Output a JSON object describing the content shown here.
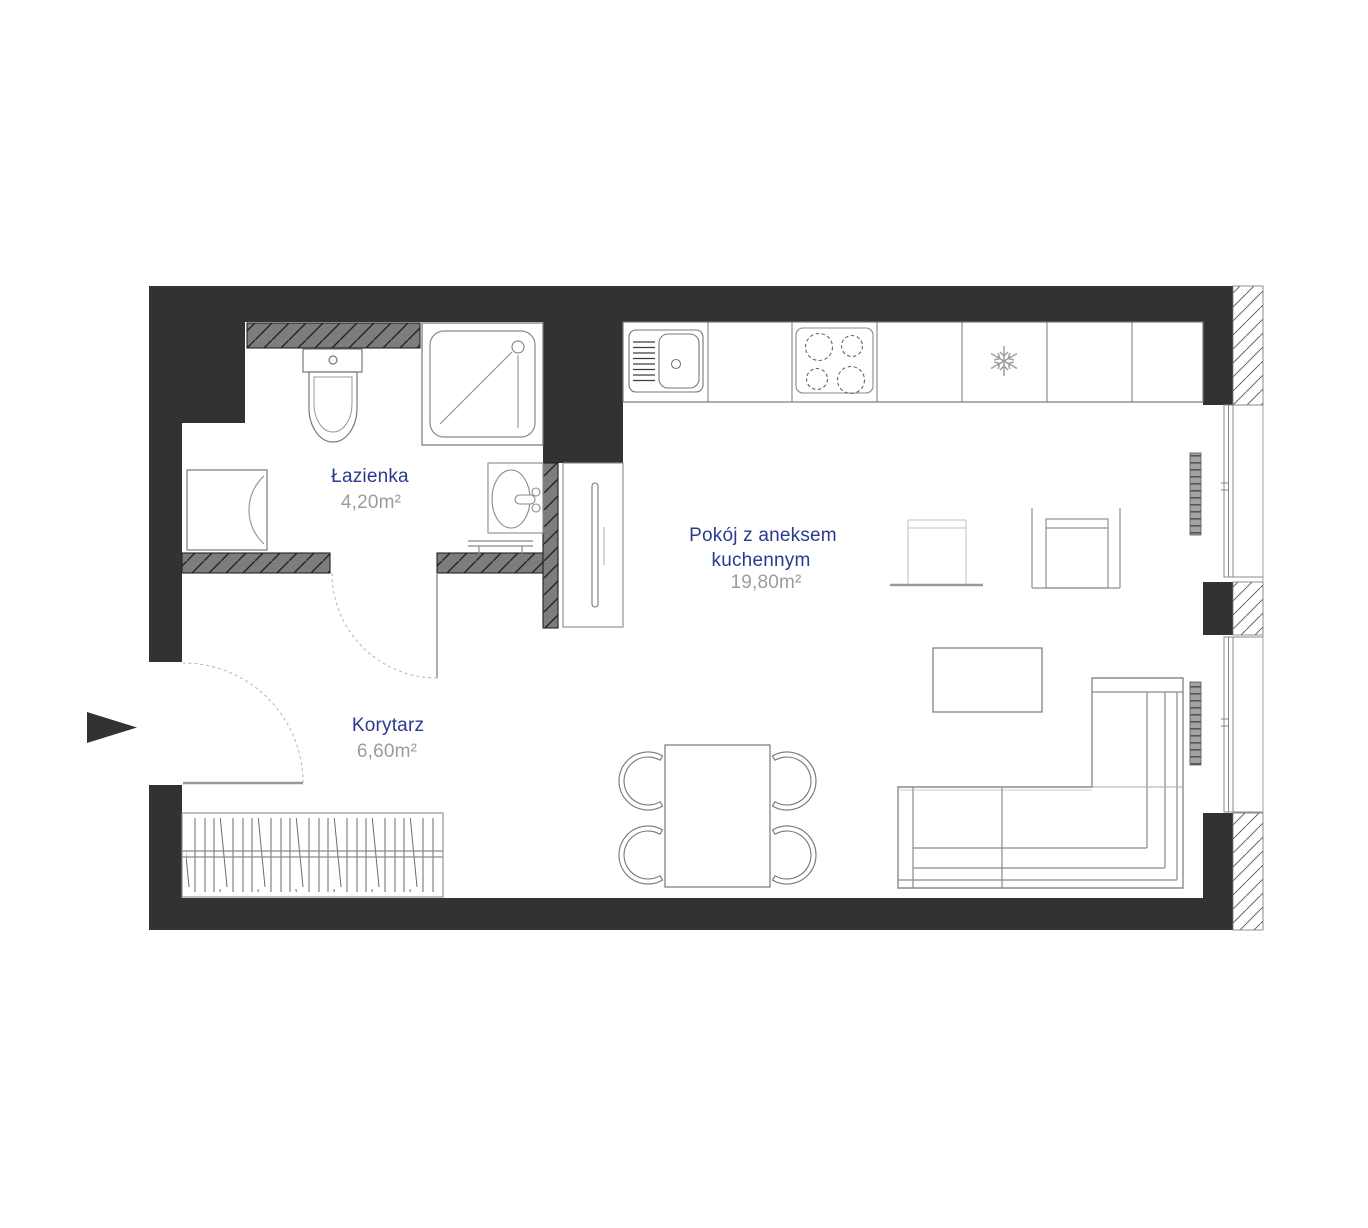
{
  "document": {
    "type": "apartment floor plan"
  },
  "rooms": {
    "bathroom": {
      "name": "Łazienka",
      "area": "4,20m²"
    },
    "living_kitchen": {
      "name_line1": "Pokój z aneksem",
      "name_line2": "kuchennym",
      "area": "19,80m²"
    },
    "corridor": {
      "name": "Korytarz",
      "area": "6,60m²"
    }
  },
  "colors": {
    "wall": "#333231",
    "partition_wall_fill": "#7d7d7d",
    "room_label": "#2b3a8f",
    "area_label": "#9c9c9c",
    "fixture_outline": "#888888",
    "background": "#ffffff"
  }
}
